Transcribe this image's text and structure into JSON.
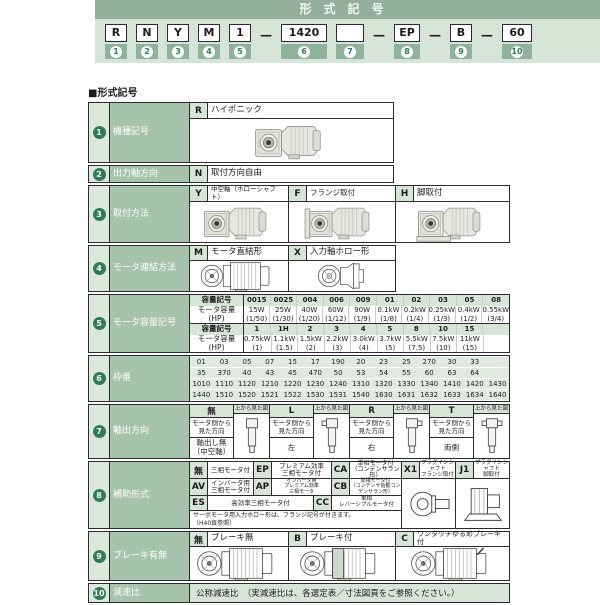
{
  "header": {
    "title": "形式記号",
    "separator": "—",
    "boxes": [
      {
        "code": "R",
        "num": "1"
      },
      {
        "code": "N",
        "num": "2"
      },
      {
        "code": "Y",
        "num": "3"
      },
      {
        "code": "M",
        "num": "4"
      },
      {
        "code": "1",
        "num": "5"
      },
      {
        "code": "1420",
        "num": "6"
      },
      {
        "code": "",
        "num": "7"
      },
      {
        "code": "EP",
        "num": "8"
      },
      {
        "code": "B",
        "num": "9"
      },
      {
        "code": "60",
        "num": "10"
      }
    ]
  },
  "section_title": "■形式記号",
  "rows": {
    "type": {
      "num": "1",
      "label": "機種記号",
      "code": "R",
      "desc": "ハイポニック"
    },
    "output_dir": {
      "num": "2",
      "label": "出力軸方向",
      "code": "N",
      "desc": "取付方向自由"
    },
    "mounting": {
      "num": "3",
      "label": "取付方法",
      "options": [
        {
          "code": "Y",
          "desc": "中空軸（ホローシャフト）"
        },
        {
          "code": "F",
          "desc": "フランジ取付"
        },
        {
          "code": "H",
          "desc": "脚取付"
        }
      ]
    },
    "motor_connection": {
      "num": "4",
      "label": "モータ連結方法",
      "options": [
        {
          "code": "M",
          "desc": "モータ直結形"
        },
        {
          "code": "X",
          "desc": "入力軸ホロー形"
        }
      ]
    },
    "capacity": {
      "num": "5",
      "label": "モータ容量記号",
      "sym_header": "容量記号",
      "cap_header": "モータ容量\n(HP)",
      "table1_symbols": [
        "0015",
        "0025",
        "004",
        "006",
        "009",
        "01",
        "02",
        "03",
        "05",
        "08"
      ],
      "table1_caps": [
        "15W\n(1/50)",
        "25W\n(1/30)",
        "40W\n(1/20)",
        "60W\n(1/12)",
        "90W\n(1/9)",
        "0.1kW\n(1/8)",
        "0.2kW\n(1/4)",
        "0.25kW\n(1/3)",
        "0.4kW\n(1/2)",
        "0.55kW\n(3/4)"
      ],
      "table2_symbols": [
        "1",
        "1H",
        "2",
        "3",
        "4",
        "5",
        "8",
        "10",
        "15",
        ""
      ],
      "table2_caps": [
        "0.75kW\n(1)",
        "1.1kW\n(1.5)",
        "1.5kW\n(2)",
        "2.2kW\n(3)",
        "3.0kW\n(4)",
        "3.7kW\n(5)",
        "5.5kW\n(7.5)",
        "7.5kW\n(10)",
        "11kW\n(15)",
        ""
      ]
    },
    "frame": {
      "num": "6",
      "label": "枠番",
      "row1": [
        "01",
        "03",
        "05",
        "07",
        "15",
        "17",
        "190",
        "20",
        "23",
        "25",
        "270",
        "30",
        "33",
        ""
      ],
      "row2": [
        "35",
        "370",
        "40",
        "43",
        "45",
        "470",
        "50",
        "53",
        "54",
        "55",
        "60",
        "63",
        "64",
        ""
      ],
      "row3": [
        "1010",
        "1110",
        "1120",
        "1210",
        "1220",
        "1230",
        "1240",
        "1310",
        "1320",
        "1330",
        "1340",
        "1410",
        "1420",
        "1430"
      ],
      "row4": [
        "1440",
        "1510",
        "1520",
        "1521",
        "1522",
        "1530",
        "1531",
        "1540",
        "1630",
        "1631",
        "1632",
        "1633",
        "1634",
        "1640"
      ]
    },
    "shaft_dir": {
      "num": "7",
      "label": "軸出方向",
      "fig_label": "上から見た図",
      "view_label": "モータ側から\n見た方向",
      "options": [
        {
          "code": "無",
          "dir": "軸出し無\n（中空軸）"
        },
        {
          "code": "L",
          "dir": "左"
        },
        {
          "code": "R",
          "dir": "右"
        },
        {
          "code": "T",
          "dir": "両側"
        }
      ]
    },
    "aux": {
      "num": "8",
      "label": "補助形式",
      "row1": [
        {
          "code": "無",
          "desc": "三相モータ付"
        },
        {
          "code": "EP",
          "desc": "プレミアム効率\n三相モータ付"
        },
        {
          "code": "CA",
          "desc": "単相モータ付\n（コンデンサラン形）"
        },
        {
          "code": "X1",
          "desc": "プラグインシャフト\nフランジ取付"
        },
        {
          "code": "J1",
          "desc": "プラグインシャフト\n脚取付"
        }
      ],
      "row2": [
        {
          "code": "AV",
          "desc": "インバータ用\n三相モータ付"
        },
        {
          "code": "AP",
          "desc": "インバータ用\nプレミアム効率\n三相モータ"
        },
        {
          "code": "CB",
          "desc": "単相モータ付\n（コンデンサ始動コンデンサラン形）"
        }
      ],
      "row3": [
        {
          "code": "ES",
          "desc": "高効率三相モータ付"
        },
        {
          "code": "CC",
          "desc": "単相\nレバーシブルモータ付"
        }
      ],
      "note": "サーボモータ用入力ホロー形は、フランジ記号が付きます。\n（H40頁参照）"
    },
    "brake": {
      "num": "9",
      "label": "ブレーキ有無",
      "options": [
        {
          "code": "無",
          "desc": "ブレーキ無"
        },
        {
          "code": "B",
          "desc": "ブレーキ付"
        },
        {
          "code": "C",
          "desc": "ワンタッチゆるめブレーキ付"
        }
      ]
    },
    "ratio": {
      "num": "10",
      "label": "減速比",
      "desc": "公称減速比　（実減速比は、各選定表／寸法図頁をご参照ください。）"
    }
  },
  "colors": {
    "accent_green": "#93af9b",
    "band_green": "#d7e4d8",
    "label_green": "#a6c3ab",
    "badge_green": "#8fb39a"
  }
}
